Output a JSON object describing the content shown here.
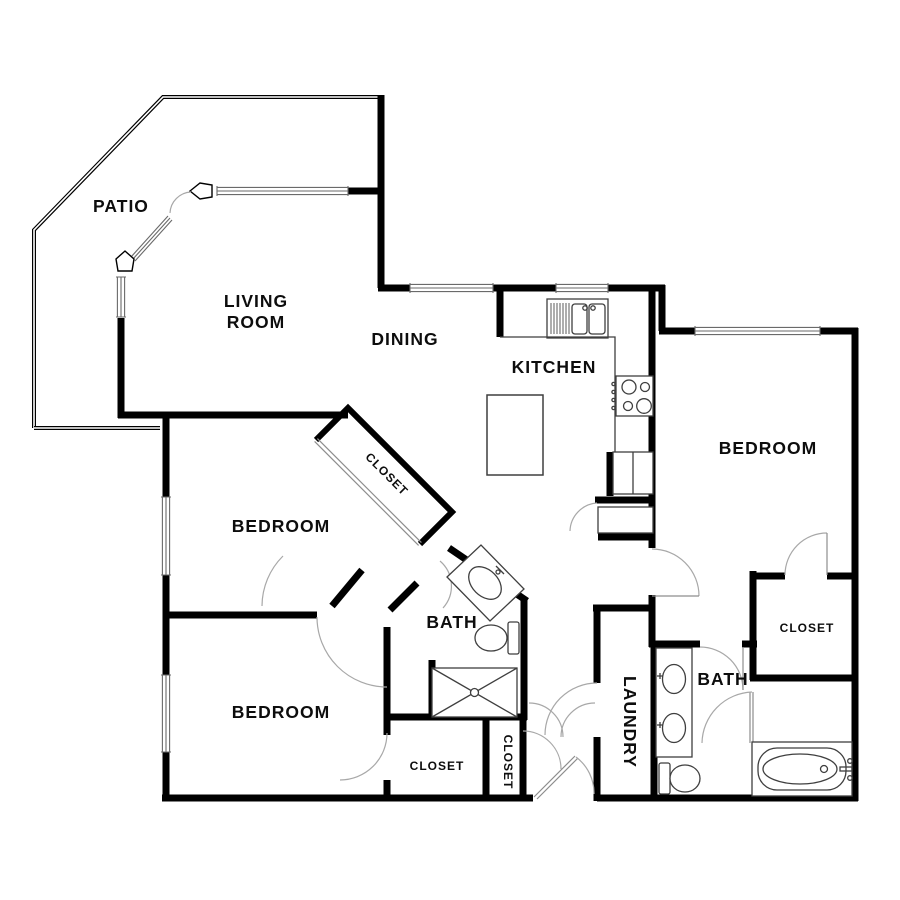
{
  "plan": {
    "type": "apartment-floor-plan",
    "background": "#ffffff",
    "wall_color": "#000000",
    "fixture_line_color": "#3f3f3f",
    "door_arc_color": "#a8a8a8"
  },
  "rooms": {
    "patio": "PATIO",
    "living_line1": "LIVING",
    "living_line2": "ROOM",
    "dining": "DINING",
    "kitchen": "KITCHEN",
    "bedroom_right": "BEDROOM",
    "bedroom_middle": "BEDROOM",
    "bedroom_bottom": "BEDROOM",
    "bath_middle": "BATH",
    "bath_right": "BATH",
    "laundry": "LAUNDRY",
    "closet_angled": "CLOSET",
    "closet_bottom": "CLOSET",
    "closet_hall": "CLOSET",
    "closet_right": "CLOSET"
  },
  "fixtures": [
    "double-kitchen-sink",
    "cooktop-4-burner",
    "refrigerator",
    "kitchen-island",
    "vanity-sink-diagonal",
    "toilet",
    "shower-stall",
    "double-vanity-sinks",
    "toilet",
    "bathtub"
  ]
}
